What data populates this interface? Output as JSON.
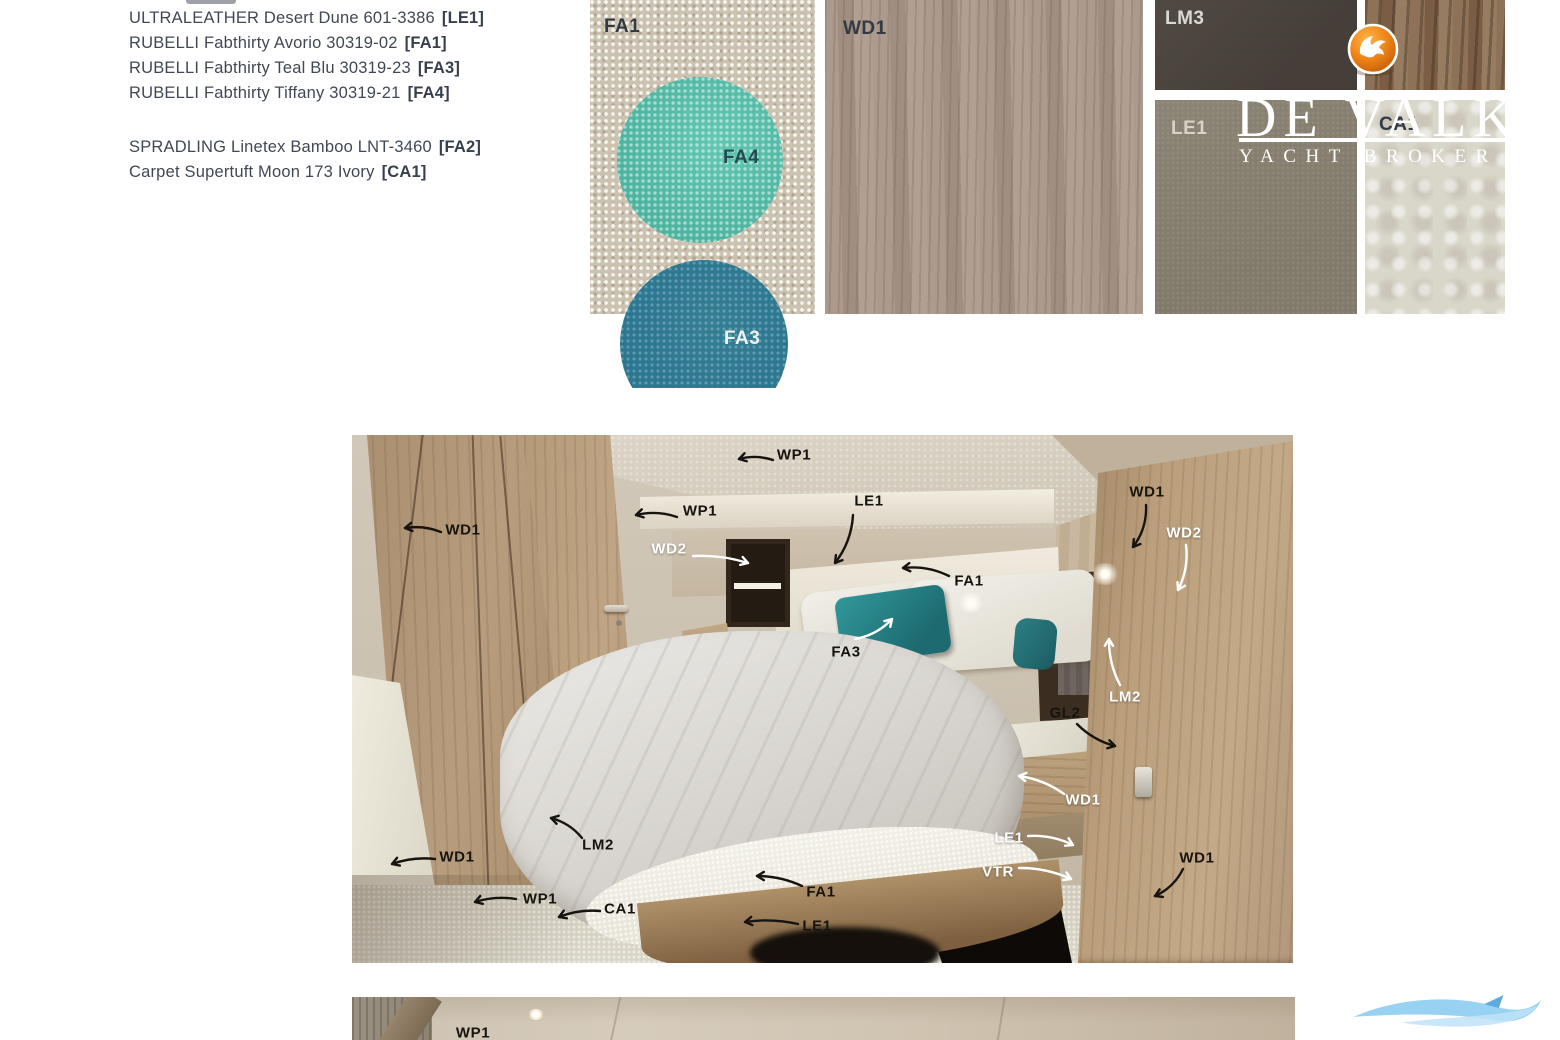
{
  "materials": [
    {
      "name": "ULTRALEATHER  Desert Dune 601-3386",
      "code": "[LE1]",
      "gap_after": false
    },
    {
      "name": "RUBELLI Fabthirty Avorio  30319-02",
      "code": "[FA1]",
      "gap_after": false
    },
    {
      "name": "RUBELLI Fabthirty Teal Blu 30319-23",
      "code": "[FA3]",
      "gap_after": false
    },
    {
      "name": "RUBELLI Fabthirty Tiffany 30319-21",
      "code": "[FA4]",
      "gap_after": true
    },
    {
      "name": "SPRADLING Linetex Bamboo LNT-3460",
      "code": "[FA2]",
      "gap_after": false
    },
    {
      "name": "Carpet Supertuft Moon 173 Ivory",
      "code": "[CA1]",
      "gap_after": false
    }
  ],
  "swatches": {
    "fa1": {
      "label": "FA1",
      "color": "#ccc2b0"
    },
    "fa4": {
      "label": "FA4",
      "color": "#4db4a0"
    },
    "fa3": {
      "label": "FA3",
      "color": "#2a7590"
    },
    "wd1": {
      "label": "WD1",
      "color": "#a89689"
    },
    "lm3": {
      "label": "LM3",
      "color": "#4a433d"
    },
    "le1": {
      "label": "LE1",
      "color": "#867f70"
    },
    "wd2_top": {
      "label": "",
      "color": "#85694f"
    },
    "ca1": {
      "label": "CA1",
      "color": "#d9d6ca"
    }
  },
  "brand": {
    "title": "DE VALK",
    "tagline": "YACHT BROKER",
    "ball_color": "#e5730f"
  },
  "annotations": [
    {
      "t": "WP1",
      "v": "d",
      "x": 442,
      "y": 20,
      "a": [
        421,
        25,
        387,
        24,
        5
      ]
    },
    {
      "t": "WD1",
      "v": "d",
      "x": 111,
      "y": 95,
      "a": [
        89,
        97,
        53,
        93,
        5
      ]
    },
    {
      "t": "WP1",
      "v": "d",
      "x": 348,
      "y": 76,
      "a": [
        325,
        82,
        284,
        80,
        6
      ]
    },
    {
      "t": "WD2",
      "v": "l",
      "x": 317,
      "y": 114,
      "a": [
        341,
        121,
        396,
        128,
        -5
      ]
    },
    {
      "t": "LE1",
      "v": "d",
      "x": 517,
      "y": 66,
      "a": [
        501,
        80,
        483,
        128,
        -8
      ]
    },
    {
      "t": "WD1",
      "v": "d",
      "x": 795,
      "y": 57,
      "a": [
        794,
        70,
        781,
        112,
        -8
      ]
    },
    {
      "t": "WD2",
      "v": "l",
      "x": 832,
      "y": 98,
      "a": [
        834,
        110,
        826,
        155,
        -7
      ]
    },
    {
      "t": "FA1",
      "v": "d",
      "x": 617,
      "y": 146,
      "a": [
        597,
        141,
        551,
        133,
        7
      ]
    },
    {
      "t": "FA3",
      "v": "d",
      "ac": "l",
      "x": 494,
      "y": 217,
      "a": [
        503,
        204,
        540,
        184,
        7
      ]
    },
    {
      "t": "LM2",
      "v": "l",
      "x": 773,
      "y": 262,
      "a": [
        768,
        250,
        757,
        204,
        -6
      ]
    },
    {
      "t": "GL2",
      "v": "d",
      "x": 713,
      "y": 278,
      "a": [
        725,
        289,
        763,
        311,
        6
      ]
    },
    {
      "t": "WD1",
      "v": "l",
      "x": 731,
      "y": 365,
      "a": [
        712,
        359,
        667,
        341,
        6
      ]
    },
    {
      "t": "LE1",
      "v": "l",
      "x": 657,
      "y": 403,
      "a": [
        676,
        401,
        721,
        410,
        -6
      ]
    },
    {
      "t": "VTR",
      "v": "l",
      "x": 646,
      "y": 437,
      "a": [
        667,
        433,
        719,
        444,
        -6
      ]
    },
    {
      "t": "WD1",
      "v": "d",
      "x": 845,
      "y": 423,
      "a": [
        831,
        434,
        803,
        461,
        -7
      ]
    },
    {
      "t": "WD1",
      "v": "d",
      "x": 105,
      "y": 422,
      "a": [
        83,
        424,
        40,
        429,
        5
      ]
    },
    {
      "t": "LM2",
      "v": "d",
      "x": 246,
      "y": 410,
      "a": [
        230,
        403,
        199,
        383,
        6
      ]
    },
    {
      "t": "WP1",
      "v": "d",
      "x": 188,
      "y": 464,
      "a": [
        164,
        464,
        123,
        467,
        5
      ]
    },
    {
      "t": "CA1",
      "v": "d",
      "x": 268,
      "y": 474,
      "a": [
        248,
        476,
        207,
        482,
        5
      ]
    },
    {
      "t": "FA1",
      "v": "d",
      "x": 469,
      "y": 457,
      "a": [
        450,
        451,
        405,
        441,
        5
      ]
    },
    {
      "t": "LE1",
      "v": "d",
      "x": 465,
      "y": 491,
      "a": [
        446,
        489,
        393,
        487,
        5
      ]
    }
  ],
  "bottom_annotations": [
    {
      "t": "WP1",
      "v": "d",
      "x": 121,
      "y": 36,
      "a": null
    }
  ],
  "annotation_colors": {
    "d": "#17140f",
    "l": "#ffffff"
  }
}
